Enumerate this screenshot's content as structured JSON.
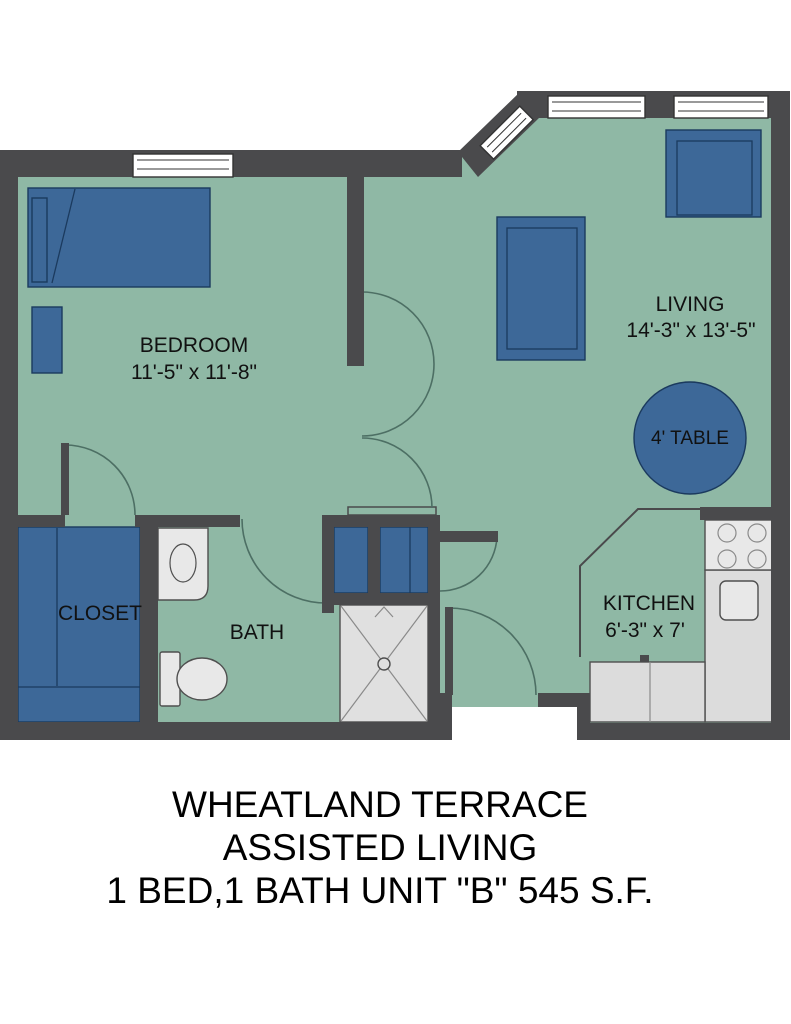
{
  "title": {
    "line1": "WHEATLAND TERRACE",
    "line2": "ASSISTED LIVING",
    "line3": "1 BED,1 BATH UNIT \"B\" 545 S.F."
  },
  "rooms": {
    "bedroom": {
      "name": "BEDROOM",
      "dims": "11'-5\" x 11'-8\""
    },
    "living": {
      "name": "LIVING",
      "dims": "14'-3\" x 13'-5\""
    },
    "kitchen": {
      "name": "KITCHEN",
      "dims": "6'-3\" x 7'"
    },
    "bath": {
      "name": "BATH"
    },
    "closet": {
      "name": "CLOSET"
    },
    "dining_table": {
      "label": "4' TABLE"
    }
  },
  "colors": {
    "floor": "#8fb8a5",
    "wall": "#4a4a4c",
    "furniture": "#3d6898",
    "furniture_stroke": "#1b3a5e",
    "fixture": "#e8e8e8",
    "counter": "#dcdcdc",
    "fixture_stroke": "#4f4f4f",
    "fixture_line": "#8a8a8a",
    "door_arc": "#4d6f64",
    "window": "#ffffff",
    "window_stroke": "#333333",
    "label_text": "#111111",
    "title_text": "#000000"
  }
}
